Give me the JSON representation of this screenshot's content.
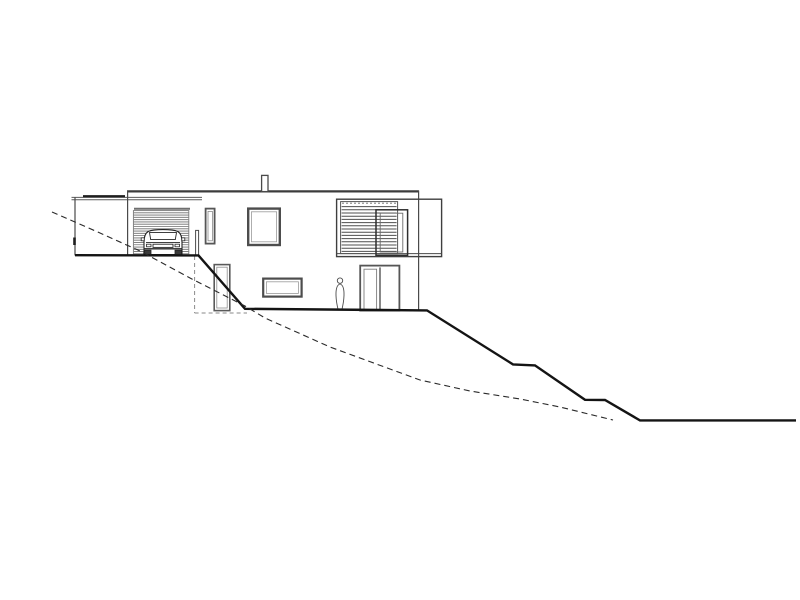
{
  "drawing": {
    "type": "architectural-elevation",
    "subject": "house-on-sloped-site-side-elevation",
    "canvas": {
      "width": 800,
      "height": 600,
      "background": "#ffffff"
    },
    "palette": {
      "ink": "#141414",
      "line": "#4a4a4a",
      "frame": "#565656",
      "light": "#8a8a8a"
    },
    "elements": [
      {
        "name": "carport-fascia-top",
        "kind": "line",
        "x1": 71.5,
        "y1": 197.4,
        "x2": 202,
        "y2": 197.4,
        "w": 1,
        "color": "#5a5a5a"
      },
      {
        "name": "carport-fascia-bottom",
        "kind": "line",
        "x1": 71.5,
        "y1": 199.8,
        "x2": 202,
        "y2": 199.8,
        "w": 1,
        "color": "#5a5a5a"
      },
      {
        "name": "carport-beam-edge",
        "kind": "line",
        "x1": 83,
        "y1": 196.2,
        "x2": 125,
        "y2": 196.2,
        "w": 2.2,
        "color": "#1e1e1e"
      },
      {
        "name": "carport-left-wall",
        "kind": "line",
        "x1": 75,
        "y1": 197.4,
        "x2": 75,
        "y2": 255.4,
        "w": 1.2,
        "color": "#4a4a4a"
      },
      {
        "name": "carport-wall-tick",
        "kind": "line",
        "x1": 74.5,
        "y1": 237.5,
        "x2": 74.5,
        "y2": 245,
        "w": 2.6,
        "color": "#1e1e1e"
      },
      {
        "name": "roof-edge",
        "kind": "line",
        "x1": 127,
        "y1": 191.4,
        "x2": 419,
        "y2": 191.4,
        "w": 2.2,
        "color": "#3c3c3c"
      },
      {
        "name": "house-left-wall",
        "kind": "line",
        "x1": 127.6,
        "y1": 190.6,
        "x2": 127.6,
        "y2": 255.4,
        "w": 1.2,
        "color": "#4a4a4a"
      },
      {
        "name": "house-right-wall",
        "kind": "line",
        "x1": 418.6,
        "y1": 190.6,
        "x2": 418.6,
        "y2": 310.4,
        "w": 1.2,
        "color": "#4a4a4a"
      },
      {
        "name": "chimney",
        "kind": "rect",
        "x": 261.6,
        "y": 175.4,
        "wd": 6.4,
        "ht": 16.2,
        "sw": 1.3,
        "color": "#4a4a4a",
        "fill": "#ffffff"
      },
      {
        "name": "garage-opening-header",
        "kind": "line",
        "x1": 134,
        "y1": 208.8,
        "x2": 190,
        "y2": 208.8,
        "w": 2,
        "color": "#6f6f6f"
      },
      {
        "name": "garage-door-frame",
        "kind": "rect",
        "x": 133.4,
        "y": 210.6,
        "wd": 55.4,
        "ht": 43.2,
        "sw": 0.9,
        "color": "#767676",
        "fill": "none"
      },
      {
        "name": "garage-door-louvers",
        "kind": "hlines",
        "x1": 133.8,
        "x2": 188.4,
        "y1": 212.8,
        "y2": 251.6,
        "n": 18,
        "w": 0.85,
        "color": "#6f6f6f"
      },
      {
        "name": "car-body",
        "kind": "path",
        "d": "M144,254.5 L144,242 Q144,233.8 148.5,231.4 Q152.5,229.6 163,229.6 Q173.5,229.6 177.5,231.4 Q182,233.8 182,242 L182,254.5 Z",
        "sw": 1.1,
        "color": "#242424",
        "fill": "#ffffff"
      },
      {
        "name": "car-windshield",
        "kind": "path",
        "d": "M149.5,232.6 L176.5,232.6 L175.3,239.6 L150.7,239.6 Z",
        "sw": 0.9,
        "color": "#242424",
        "fill": "#ffffff"
      },
      {
        "name": "car-mirror-left",
        "kind": "rect",
        "x": 141.2,
        "y": 237.8,
        "wd": 3,
        "ht": 3,
        "sw": 0.8,
        "color": "#242424",
        "fill": "#ffffff"
      },
      {
        "name": "car-mirror-right",
        "kind": "rect",
        "x": 181.8,
        "y": 237.8,
        "wd": 3,
        "ht": 3,
        "sw": 0.8,
        "color": "#242424",
        "fill": "#ffffff"
      },
      {
        "name": "car-hood-line",
        "kind": "line",
        "x1": 146,
        "y1": 242.6,
        "x2": 180,
        "y2": 242.6,
        "w": 0.9,
        "color": "#242424"
      },
      {
        "name": "car-grille",
        "kind": "rect",
        "x": 153,
        "y": 244.2,
        "wd": 20,
        "ht": 3.2,
        "sw": 0.9,
        "color": "#242424",
        "fill": "#ffffff"
      },
      {
        "name": "car-headlight-left",
        "kind": "rect",
        "x": 146.5,
        "y": 244.2,
        "wd": 4.5,
        "ht": 2.6,
        "sw": 0.8,
        "color": "#242424",
        "fill": "#ffffff"
      },
      {
        "name": "car-headlight-right",
        "kind": "rect",
        "x": 175,
        "y": 244.2,
        "wd": 4.5,
        "ht": 2.6,
        "sw": 0.8,
        "color": "#242424",
        "fill": "#ffffff"
      },
      {
        "name": "car-bumper",
        "kind": "line",
        "x1": 144.5,
        "y1": 248.8,
        "x2": 181.5,
        "y2": 248.8,
        "w": 1.4,
        "color": "#242424"
      },
      {
        "name": "car-wheel-left",
        "kind": "rect",
        "x": 144.5,
        "y": 250.2,
        "wd": 6.5,
        "ht": 4.6,
        "sw": 0.8,
        "color": "#242424",
        "fill": "#3a3a3a"
      },
      {
        "name": "car-wheel-right",
        "kind": "rect",
        "x": 175,
        "y": 250.2,
        "wd": 6.5,
        "ht": 4.6,
        "sw": 0.8,
        "color": "#242424",
        "fill": "#3a3a3a"
      },
      {
        "name": "garage-corner-post",
        "kind": "rect",
        "x": 195.6,
        "y": 230.4,
        "wd": 3,
        "ht": 25,
        "sw": 1,
        "color": "#4a4a4a",
        "fill": "#ffffff"
      },
      {
        "name": "window-narrow-frame",
        "kind": "rect",
        "x": 205.6,
        "y": 208.6,
        "wd": 9,
        "ht": 35,
        "sw": 1.8,
        "color": "#565656",
        "fill": "#ffffff"
      },
      {
        "name": "window-narrow-inner",
        "kind": "rect",
        "x": 208,
        "y": 211.4,
        "wd": 4.4,
        "ht": 29.4,
        "sw": 0.8,
        "color": "#8a8a8a",
        "fill": "none"
      },
      {
        "name": "window-square-frame",
        "kind": "rect",
        "x": 248.2,
        "y": 208.6,
        "wd": 31.6,
        "ht": 36.4,
        "sw": 2.4,
        "color": "#4d4d4d",
        "fill": "#ffffff"
      },
      {
        "name": "window-square-inner",
        "kind": "rect",
        "x": 251.4,
        "y": 211.8,
        "wd": 25.2,
        "ht": 30,
        "sw": 0.8,
        "color": "#9a9a9a",
        "fill": "none"
      },
      {
        "name": "window-box-frame",
        "kind": "rect",
        "x": 336.6,
        "y": 199.2,
        "wd": 105,
        "ht": 57.4,
        "sw": 1.4,
        "color": "#3f3f3f",
        "fill": "none"
      },
      {
        "name": "window-box-bottom-line",
        "kind": "line",
        "x1": 336.6,
        "y1": 253.6,
        "x2": 441.6,
        "y2": 253.6,
        "w": 1,
        "color": "#4a4a4a"
      },
      {
        "name": "louver-window-frame",
        "kind": "rect",
        "x": 340.6,
        "y": 201.6,
        "wd": 57,
        "ht": 52,
        "sw": 1,
        "color": "#565656",
        "fill": "none"
      },
      {
        "name": "louver-window-track",
        "kind": "line",
        "x1": 342,
        "y1": 203.2,
        "x2": 396.6,
        "y2": 203.2,
        "w": 0.8,
        "color": "#6a6a6a",
        "dash": "2 2"
      },
      {
        "name": "louver-window-slats",
        "kind": "hlines",
        "x1": 341.6,
        "x2": 396.6,
        "y1": 206.6,
        "y2": 251.4,
        "n": 15,
        "w": 1,
        "color": "#4f4f4f"
      },
      {
        "name": "sliding-panel-frame",
        "kind": "rect",
        "x": 376,
        "y": 209.8,
        "wd": 31.6,
        "ht": 45.5,
        "sw": 1.5,
        "color": "#2e2e2e",
        "fill": "none"
      },
      {
        "name": "sliding-panel-inner",
        "kind": "rect",
        "x": 380.2,
        "y": 213.2,
        "wd": 22.6,
        "ht": 38.8,
        "sw": 0.9,
        "color": "#6a6a6a",
        "fill": "none"
      },
      {
        "name": "basement-door-frame",
        "kind": "rect",
        "x": 214.2,
        "y": 264.6,
        "wd": 15.6,
        "ht": 46,
        "sw": 1.6,
        "color": "#5a5a5a",
        "fill": "#ffffff"
      },
      {
        "name": "basement-door-inner",
        "kind": "rect",
        "x": 216.8,
        "y": 267.2,
        "wd": 10.4,
        "ht": 40.8,
        "sw": 0.8,
        "color": "#8e8e8e",
        "fill": "none"
      },
      {
        "name": "basement-window-frame",
        "kind": "rect",
        "x": 263.2,
        "y": 278.6,
        "wd": 38.4,
        "ht": 18,
        "sw": 2.2,
        "color": "#4d4d4d",
        "fill": "#ffffff"
      },
      {
        "name": "basement-window-inner",
        "kind": "rect",
        "x": 266.4,
        "y": 281.8,
        "wd": 32,
        "ht": 11.6,
        "sw": 0.8,
        "color": "#9a9a9a",
        "fill": "none"
      },
      {
        "name": "patio-door-frame",
        "kind": "rect",
        "x": 360.2,
        "y": 265.6,
        "wd": 39.2,
        "ht": 45,
        "sw": 1.8,
        "color": "#565656",
        "fill": "#ffffff"
      },
      {
        "name": "patio-door-divider",
        "kind": "line",
        "x1": 380,
        "y1": 267.4,
        "x2": 380,
        "y2": 310.4,
        "w": 1.4,
        "color": "#565656"
      },
      {
        "name": "patio-door-glass",
        "kind": "rect",
        "x": 364,
        "y": 269.2,
        "wd": 12.6,
        "ht": 41,
        "sw": 0.9,
        "color": "#7e7e7e",
        "fill": "none"
      },
      {
        "name": "person-head",
        "kind": "circle",
        "cx": 340,
        "cy": 280.6,
        "r": 2.7,
        "sw": 0.9,
        "color": "#4a4a4a",
        "fill": "#ffffff"
      },
      {
        "name": "person-body",
        "kind": "path",
        "d": "M340,284 C337,284.8 335.8,289 336,295.5 C336.2,301.5 337.4,306.8 338.2,310 L341.8,310 C342.6,306.8 343.8,301.5 344,295.5 C344.2,289 343,284.8 340,284 Z",
        "sw": 0.9,
        "color": "#4a4a4a",
        "fill": "#ffffff"
      },
      {
        "name": "hidden-basement-wall",
        "kind": "line",
        "x1": 194.6,
        "y1": 256,
        "x2": 194.6,
        "y2": 313,
        "w": 1,
        "color": "#8a8a8a",
        "dash": "4 3"
      },
      {
        "name": "hidden-basement-floor",
        "kind": "line",
        "x1": 194.6,
        "y1": 313,
        "x2": 247,
        "y2": 313,
        "w": 1,
        "color": "#8a8a8a",
        "dash": "4 3"
      },
      {
        "name": "terrain-proposed-grade",
        "kind": "polyline",
        "w": 2.4,
        "color": "#141414",
        "points": [
          [
            75,
            255.2
          ],
          [
            198.5,
            255.4
          ],
          [
            245,
            308.8
          ],
          [
            427,
            310.4
          ],
          [
            513,
            364.4
          ],
          [
            535,
            365.4
          ],
          [
            585,
            399.8
          ],
          [
            605,
            400
          ],
          [
            640,
            420.4
          ],
          [
            796,
            420.4
          ]
        ]
      },
      {
        "name": "terrain-existing-grade",
        "kind": "polyline",
        "w": 1.1,
        "color": "#2a2a2a",
        "dash": "6 4",
        "points": [
          [
            52,
            212
          ],
          [
            100,
            233
          ],
          [
            140,
            251
          ],
          [
            190,
            278
          ],
          [
            245,
            306
          ],
          [
            265,
            318
          ],
          [
            330,
            347
          ],
          [
            420,
            380
          ],
          [
            470,
            391
          ],
          [
            520,
            399
          ],
          [
            560,
            407
          ],
          [
            613,
            420
          ]
        ]
      }
    ]
  }
}
